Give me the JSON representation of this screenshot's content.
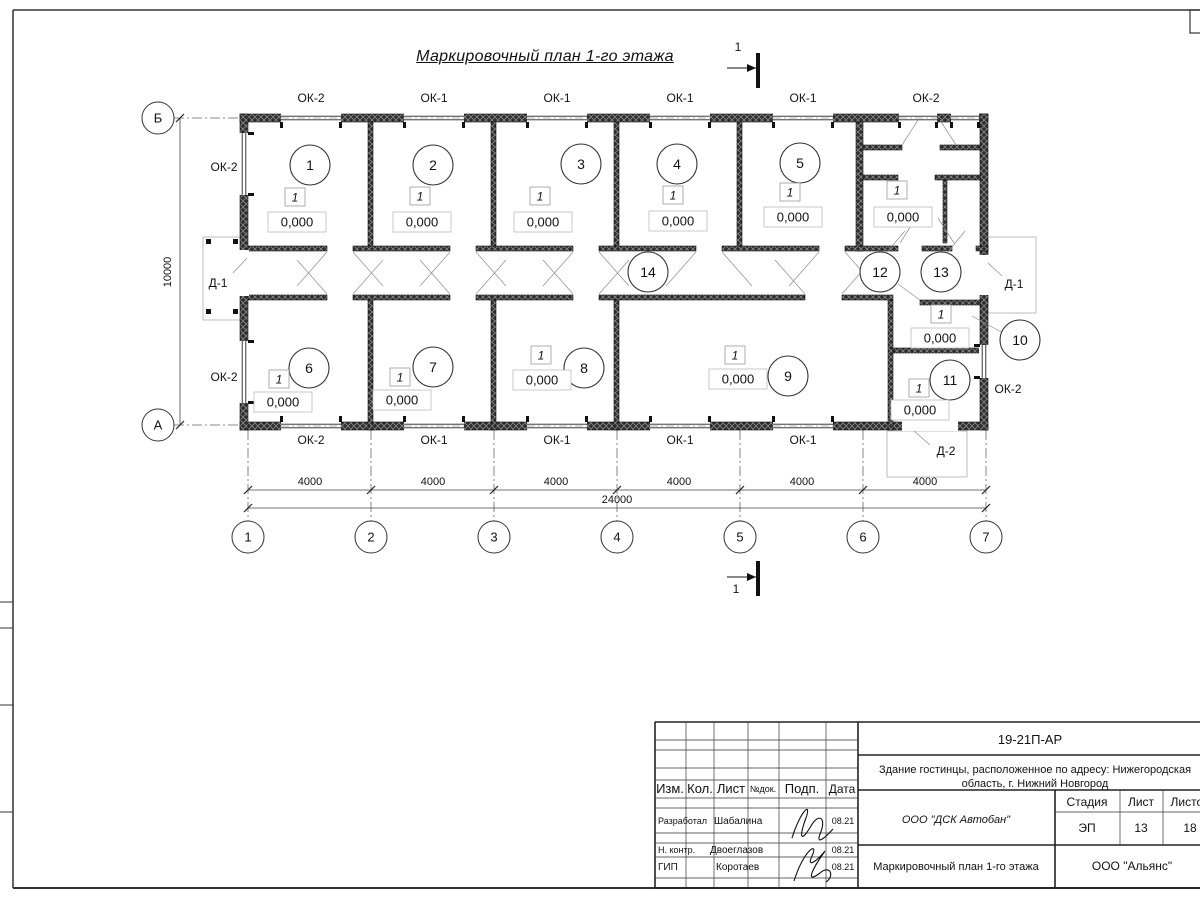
{
  "sheet": {
    "frame": {
      "left": 13,
      "top": 10,
      "bottom": 888,
      "corner_box": [
        1190,
        10,
        25,
        23
      ]
    },
    "margin_ticks_y": [
      602,
      628,
      705,
      812
    ]
  },
  "title": {
    "text": "Маркировочный план 1-го этажа"
  },
  "plan": {
    "axes": {
      "x": [
        {
          "label": "1",
          "x": 248
        },
        {
          "label": "2",
          "x": 371
        },
        {
          "label": "3",
          "x": 494
        },
        {
          "label": "4",
          "x": 617
        },
        {
          "label": "5",
          "x": 740
        },
        {
          "label": "6",
          "x": 863
        },
        {
          "label": "7",
          "x": 986
        }
      ],
      "y": [
        {
          "label": "Б",
          "y": 118
        },
        {
          "label": "А",
          "y": 425
        }
      ],
      "circle_r": 16,
      "bottom_cy": 537,
      "left_cx": 158
    },
    "walls": {
      "exterior": [
        [
          240,
          114,
          748,
          8
        ],
        [
          240,
          422,
          748,
          8
        ],
        [
          240,
          114,
          8,
          316
        ],
        [
          980,
          114,
          8,
          316
        ]
      ],
      "partitions": [
        [
          368,
          122,
          5,
          124
        ],
        [
          491,
          122,
          5,
          124
        ],
        [
          614,
          122,
          5,
          124
        ],
        [
          737,
          122,
          5,
          124
        ],
        [
          856,
          122,
          7,
          129
        ],
        [
          368,
          300,
          5,
          130
        ],
        [
          491,
          300,
          5,
          130
        ],
        [
          614,
          300,
          5,
          130
        ],
        [
          888,
          300,
          5,
          130
        ],
        [
          893,
          348,
          87,
          5
        ],
        [
          863,
          145,
          39,
          5
        ],
        [
          940,
          145,
          40,
          5
        ],
        [
          863,
          175,
          35,
          5
        ],
        [
          935,
          175,
          45,
          5
        ],
        [
          943,
          180,
          4,
          63
        ]
      ],
      "corridor_top": {
        "y": 246,
        "h": 5,
        "segments": [
          [
            248,
            327
          ],
          [
            353,
            450
          ],
          [
            476,
            573
          ],
          [
            599,
            696
          ],
          [
            722,
            819
          ],
          [
            845,
            898
          ],
          [
            922,
            952
          ],
          [
            976,
            988
          ]
        ]
      },
      "corridor_bottom": {
        "y": 295,
        "h": 5,
        "segments": [
          [
            248,
            327
          ],
          [
            353,
            450
          ],
          [
            476,
            573
          ],
          [
            599,
            805
          ],
          [
            842,
            893
          ]
        ]
      },
      "block_top": {
        "y": 300,
        "h": 5,
        "segments": [
          [
            920,
            980
          ]
        ]
      }
    },
    "openings": {
      "windows_h": [
        {
          "x": 281,
          "y": 113,
          "w": 60
        },
        {
          "x": 404,
          "y": 113,
          "w": 60
        },
        {
          "x": 527,
          "y": 113,
          "w": 60
        },
        {
          "x": 650,
          "y": 113,
          "w": 60
        },
        {
          "x": 773,
          "y": 113,
          "w": 60
        },
        {
          "x": 899,
          "y": 113,
          "w": 38
        },
        {
          "x": 951,
          "y": 113,
          "w": 28
        },
        {
          "x": 281,
          "y": 421,
          "w": 60
        },
        {
          "x": 404,
          "y": 421,
          "w": 60
        },
        {
          "x": 527,
          "y": 421,
          "w": 60
        },
        {
          "x": 650,
          "y": 421,
          "w": 60
        },
        {
          "x": 773,
          "y": 421,
          "w": 60
        }
      ],
      "windows_v": [
        {
          "x": 239,
          "y": 133,
          "h": 62
        },
        {
          "x": 239,
          "y": 341,
          "h": 62
        },
        {
          "x": 979,
          "y": 345,
          "h": 33
        }
      ],
      "doors_h": [
        {
          "x": 902,
          "y": 421,
          "w": 56
        }
      ],
      "doors_v": [
        {
          "x": 239,
          "y": 250,
          "h": 46
        },
        {
          "x": 979,
          "y": 255,
          "h": 40
        }
      ]
    },
    "window_labels": [
      {
        "text": "ОК-2",
        "x": 311,
        "y": 102
      },
      {
        "text": "ОК-1",
        "x": 434,
        "y": 102
      },
      {
        "text": "ОК-1",
        "x": 557,
        "y": 102
      },
      {
        "text": "ОК-1",
        "x": 680,
        "y": 102
      },
      {
        "text": "ОК-1",
        "x": 803,
        "y": 102
      },
      {
        "text": "ОК-2",
        "x": 926,
        "y": 102
      },
      {
        "text": "ОК-2",
        "x": 311,
        "y": 444
      },
      {
        "text": "ОК-1",
        "x": 434,
        "y": 444
      },
      {
        "text": "ОК-1",
        "x": 557,
        "y": 444
      },
      {
        "text": "ОК-1",
        "x": 680,
        "y": 444
      },
      {
        "text": "ОК-1",
        "x": 803,
        "y": 444
      },
      {
        "text": "ОК-2",
        "x": 224,
        "y": 171
      },
      {
        "text": "ОК-2",
        "x": 224,
        "y": 381
      },
      {
        "text": "Д-1",
        "x": 218,
        "y": 287
      },
      {
        "text": "Д-1",
        "x": 1014,
        "y": 288
      },
      {
        "text": "ОК-2",
        "x": 1008,
        "y": 393
      },
      {
        "text": "Д-2",
        "x": 946,
        "y": 455
      }
    ],
    "rooms": [
      {
        "n": "1",
        "cx": 310,
        "cy": 165
      },
      {
        "n": "2",
        "cx": 433,
        "cy": 165
      },
      {
        "n": "3",
        "cx": 581,
        "cy": 164
      },
      {
        "n": "4",
        "cx": 677,
        "cy": 164
      },
      {
        "n": "5",
        "cx": 800,
        "cy": 163
      },
      {
        "n": "6",
        "cx": 309,
        "cy": 368
      },
      {
        "n": "7",
        "cx": 433,
        "cy": 367
      },
      {
        "n": "8",
        "cx": 584,
        "cy": 368
      },
      {
        "n": "9",
        "cx": 788,
        "cy": 376
      },
      {
        "n": "10",
        "cx": 1020,
        "cy": 340,
        "leader": [
          1003,
          333,
          972,
          316
        ]
      },
      {
        "n": "11",
        "cx": 950,
        "cy": 380
      },
      {
        "n": "12",
        "cx": 880,
        "cy": 272,
        "leader": [
          886,
          253,
          905,
          231
        ]
      },
      {
        "n": "13",
        "cx": 941,
        "cy": 272,
        "leader": [
          947,
          253,
          965,
          231
        ]
      },
      {
        "n": "14",
        "cx": 648,
        "cy": 272
      }
    ],
    "level_marks": {
      "tag": "1",
      "value": "0,000",
      "tag_boxes": [
        [
          295,
          197
        ],
        [
          420,
          196
        ],
        [
          540,
          196
        ],
        [
          673,
          195
        ],
        [
          790,
          192
        ],
        [
          897,
          190
        ],
        [
          279,
          379
        ],
        [
          400,
          377
        ],
        [
          541,
          355
        ],
        [
          735,
          355
        ],
        [
          941,
          314
        ],
        [
          919,
          388
        ]
      ],
      "value_boxes": [
        [
          297,
          222
        ],
        [
          422,
          222
        ],
        [
          543,
          222
        ],
        [
          678,
          221
        ],
        [
          793,
          217
        ],
        [
          903,
          217
        ],
        [
          283,
          402
        ],
        [
          402,
          400
        ],
        [
          542,
          380
        ],
        [
          738,
          379
        ],
        [
          940,
          338
        ],
        [
          920,
          410
        ]
      ]
    },
    "porches": [
      {
        "x": 203,
        "y": 237,
        "w": 42,
        "h": 83,
        "columns": [
          [
            206,
            239
          ],
          [
            233,
            239
          ],
          [
            206,
            309
          ],
          [
            233,
            309
          ]
        ]
      },
      {
        "x": 988,
        "y": 237,
        "w": 48,
        "h": 76,
        "columns": []
      },
      {
        "x": 887,
        "y": 431,
        "w": 80,
        "h": 46,
        "columns": []
      }
    ],
    "thin_lines": [
      [
        327,
        252,
        297,
        286
      ],
      [
        353,
        252,
        383,
        286
      ],
      [
        450,
        252,
        420,
        286
      ],
      [
        476,
        252,
        506,
        286
      ],
      [
        573,
        252,
        543,
        286
      ],
      [
        599,
        252,
        629,
        286
      ],
      [
        696,
        252,
        666,
        286
      ],
      [
        722,
        252,
        752,
        286
      ],
      [
        819,
        252,
        789,
        286
      ],
      [
        845,
        252,
        875,
        286
      ],
      [
        327,
        294,
        297,
        260
      ],
      [
        353,
        294,
        383,
        260
      ],
      [
        450,
        294,
        420,
        260
      ],
      [
        476,
        294,
        506,
        260
      ],
      [
        573,
        294,
        543,
        260
      ],
      [
        599,
        294,
        629,
        260
      ],
      [
        805,
        294,
        775,
        260
      ],
      [
        842,
        294,
        872,
        260
      ],
      [
        900,
        243,
        916,
        218
      ],
      [
        954,
        243,
        938,
        218
      ],
      [
        902,
        145,
        918,
        120
      ],
      [
        956,
        145,
        940,
        120
      ],
      [
        898,
        284,
        920,
        300
      ],
      [
        233,
        273,
        247,
        258
      ],
      [
        1002,
        276,
        988,
        263
      ],
      [
        930,
        445,
        914,
        431
      ]
    ],
    "dimensions": {
      "row1": {
        "y": 490,
        "x0": 248,
        "x1": 986,
        "tick_xs": [
          248,
          371,
          494,
          617,
          740,
          863,
          986
        ],
        "labels": [
          {
            "text": "4000",
            "cx": 310
          },
          {
            "text": "4000",
            "cx": 433
          },
          {
            "text": "4000",
            "cx": 556
          },
          {
            "text": "4000",
            "cx": 679
          },
          {
            "text": "4000",
            "cx": 802
          },
          {
            "text": "4000",
            "cx": 925
          }
        ]
      },
      "row2": {
        "y": 508,
        "x0": 248,
        "x1": 986,
        "tick_xs": [
          248,
          986
        ],
        "label": {
          "text": "24000",
          "cx": 617
        }
      },
      "vert": {
        "x": 180,
        "y0": 118,
        "y1": 425,
        "tick_ys": [
          118,
          425
        ],
        "label": {
          "text": "10000",
          "cx": 171,
          "cy": 272
        }
      }
    },
    "sections": [
      {
        "label": "1",
        "line": [
          727,
          68,
          756,
          68
        ],
        "bar": [
          756,
          53,
          4,
          35
        ],
        "label_at": [
          738,
          51
        ]
      },
      {
        "label": "1",
        "line": [
          727,
          577,
          756,
          577
        ],
        "bar": [
          756,
          561,
          4,
          35
        ],
        "label_at": [
          736,
          593
        ]
      }
    ]
  },
  "titleblock": {
    "frame": [
      655,
      722,
      1210,
      888
    ],
    "thick_lines": [
      [
        655,
        722,
        1210,
        722
      ],
      [
        655,
        888,
        1210,
        888
      ],
      [
        655,
        722,
        655,
        888
      ],
      [
        858,
        722,
        858,
        888
      ],
      [
        858,
        755,
        1210,
        755
      ],
      [
        858,
        790,
        1210,
        790
      ],
      [
        858,
        845,
        1210,
        845
      ],
      [
        1055,
        790,
        1055,
        888
      ]
    ],
    "thin_lines": [
      [
        686,
        722,
        686,
        888
      ],
      [
        714,
        722,
        714,
        888
      ],
      [
        748,
        722,
        748,
        888
      ],
      [
        779,
        722,
        779,
        888
      ],
      [
        826,
        722,
        826,
        888
      ],
      [
        655,
        740,
        858,
        740
      ],
      [
        655,
        750,
        858,
        750
      ],
      [
        655,
        768,
        858,
        768
      ],
      [
        655,
        780,
        858,
        780
      ],
      [
        655,
        798,
        858,
        798
      ],
      [
        655,
        808,
        858,
        808
      ],
      [
        655,
        833,
        858,
        833
      ],
      [
        655,
        843,
        858,
        843
      ],
      [
        655,
        857,
        858,
        857
      ],
      [
        655,
        878,
        858,
        878
      ],
      [
        1055,
        812,
        1210,
        812
      ],
      [
        1120,
        790,
        1120,
        845
      ],
      [
        1163,
        790,
        1163,
        845
      ]
    ],
    "cells": [
      {
        "t": "Изм.",
        "x": 670,
        "y": 793,
        "fs": 13
      },
      {
        "t": "Кол.",
        "x": 700,
        "y": 793,
        "fs": 13
      },
      {
        "t": "Лист",
        "x": 731,
        "y": 793,
        "fs": 13
      },
      {
        "t": "№док.",
        "x": 763,
        "y": 792,
        "fs": 9
      },
      {
        "t": "Подп.",
        "x": 802,
        "y": 793,
        "fs": 13
      },
      {
        "t": "Дата",
        "x": 842,
        "y": 793,
        "fs": 12
      },
      {
        "t": "Разработал",
        "x": 658,
        "y": 824,
        "fs": 9,
        "a": "start"
      },
      {
        "t": "Шабалина",
        "x": 714,
        "y": 824,
        "fs": 10,
        "a": "start"
      },
      {
        "t": "08.21",
        "x": 843,
        "y": 824,
        "fs": 9
      },
      {
        "t": "Н. контр.",
        "x": 658,
        "y": 853,
        "fs": 9,
        "a": "start"
      },
      {
        "t": "Двоеглазов",
        "x": 710,
        "y": 853,
        "fs": 10,
        "a": "start"
      },
      {
        "t": "08.21",
        "x": 843,
        "y": 853,
        "fs": 9
      },
      {
        "t": "ГИП",
        "x": 658,
        "y": 870,
        "fs": 10,
        "a": "start"
      },
      {
        "t": "Коротаев",
        "x": 716,
        "y": 870,
        "fs": 10,
        "a": "start"
      },
      {
        "t": "08.21",
        "x": 843,
        "y": 870,
        "fs": 9
      },
      {
        "t": "19-21П-АР",
        "x": 1030,
        "y": 744,
        "fs": 13
      },
      {
        "t": "Здание гостинцы, расположенное по адресу: Нижегородская",
        "x": 1035,
        "y": 773,
        "fs": 11
      },
      {
        "t": "область, г. Нижний Новгород",
        "x": 1035,
        "y": 787,
        "fs": 11
      },
      {
        "t": "ООО \"ДСК Автобан\"",
        "x": 956,
        "y": 823,
        "fs": 11,
        "i": true
      },
      {
        "t": "Маркировочный план 1-го этажа",
        "x": 956,
        "y": 870,
        "fs": 11
      },
      {
        "t": "Стадия",
        "x": 1087,
        "y": 806,
        "fs": 12
      },
      {
        "t": "Лист",
        "x": 1141,
        "y": 806,
        "fs": 12
      },
      {
        "t": "Листов",
        "x": 1190,
        "y": 806,
        "fs": 12
      },
      {
        "t": "ЭП",
        "x": 1087,
        "y": 832,
        "fs": 12
      },
      {
        "t": "13",
        "x": 1141,
        "y": 832,
        "fs": 12
      },
      {
        "t": "18",
        "x": 1190,
        "y": 832,
        "fs": 12
      },
      {
        "t": "ООО \"Альянс\"",
        "x": 1132,
        "y": 870,
        "fs": 12
      }
    ],
    "signatures": [
      "M792,838 C800,812 812,800 806,818 C800,834 799,846 811,826 C819,812 827,818 820,834 C816,845 824,839 833,829",
      "M794,881 C804,849 819,841 812,856 C806,869 817,861 825,851 C813,868 804,885 820,873 C830,864 835,876 826,882"
    ]
  }
}
